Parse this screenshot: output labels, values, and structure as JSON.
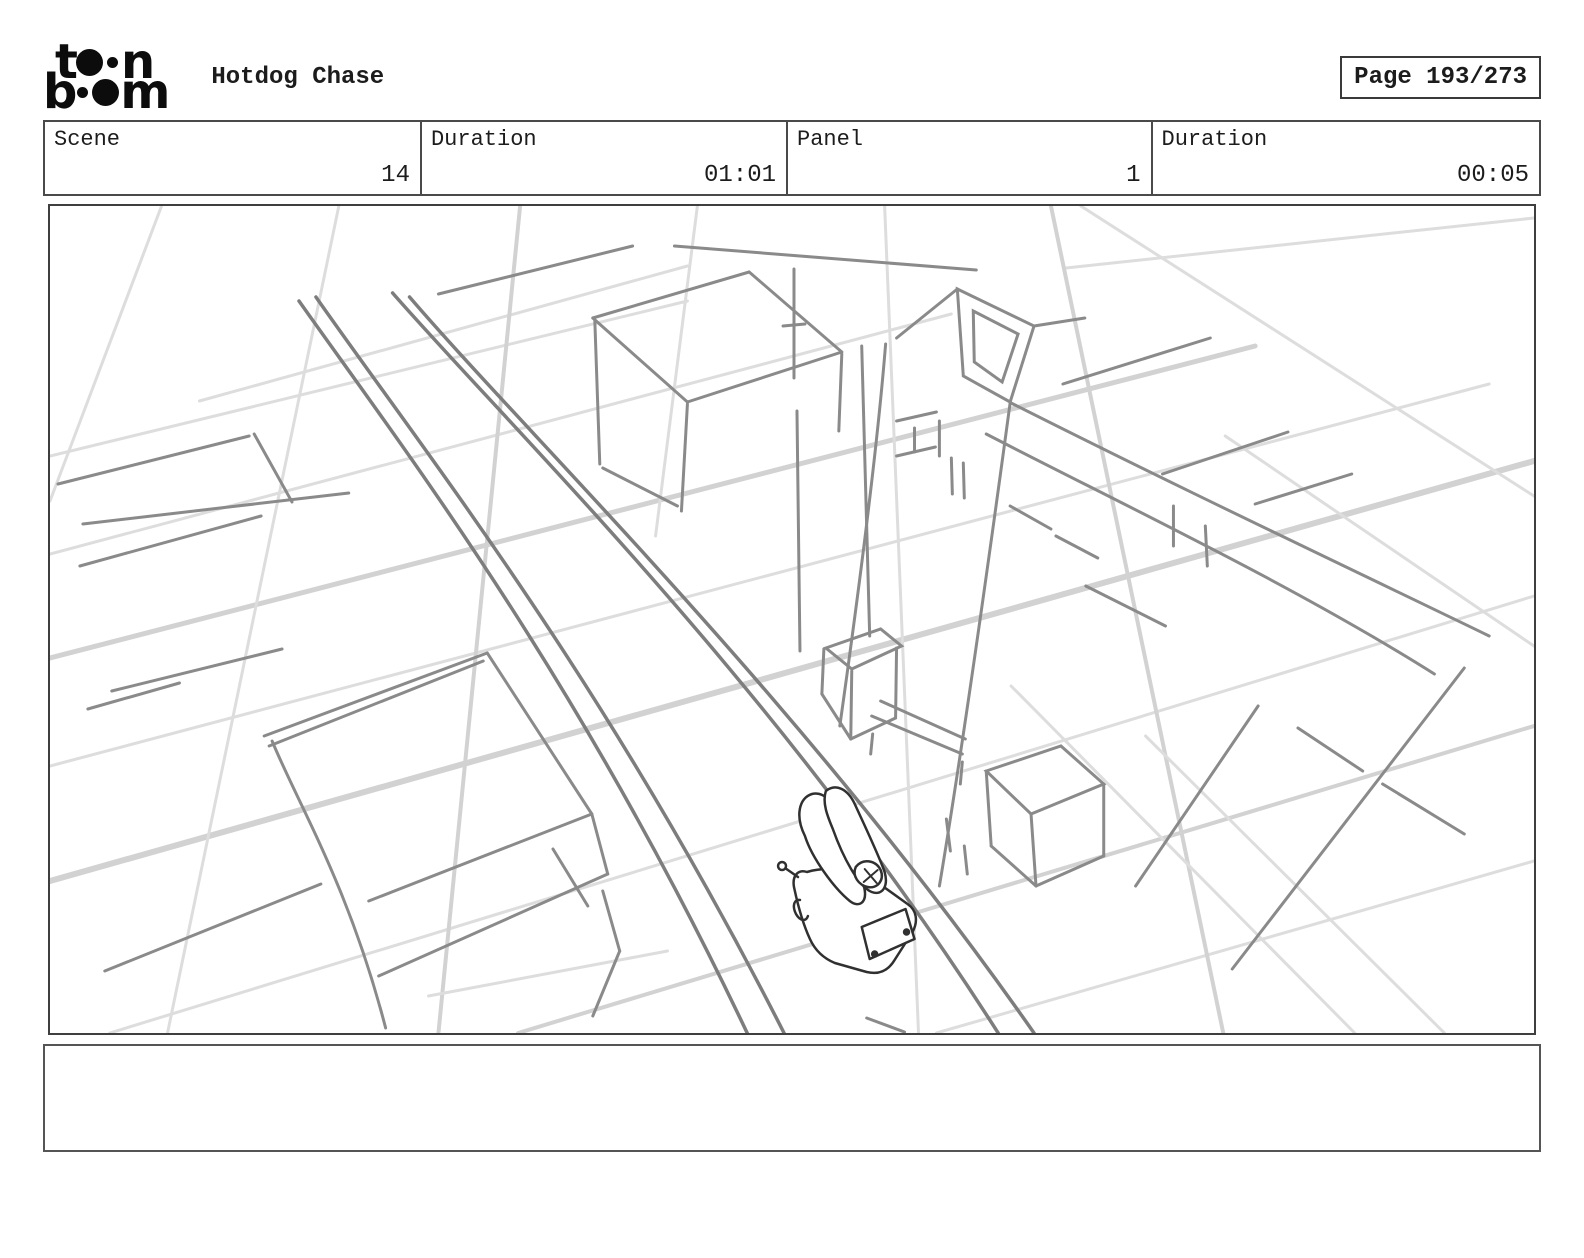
{
  "header": {
    "logo": {
      "l1a": "t",
      "l1b": "n",
      "l2a": "b",
      "l2b": "m"
    },
    "title": "Hotdog Chase",
    "page_label": "Page 193/273"
  },
  "info_row": {
    "cells": [
      {
        "label": "Scene",
        "value": "14"
      },
      {
        "label": "Duration",
        "value": "01:01"
      },
      {
        "label": "Panel",
        "value": "1"
      },
      {
        "label": "Duration",
        "value": "00:05"
      }
    ]
  },
  "panel": {
    "description": "rough pencil sketch: aerial perspective of city street grid with buildings, a rooftop billboard tower, and a hotdog truck driving down the street",
    "caption": ""
  },
  "colors": {
    "ink": "#1c1c1c",
    "border": "#4a4a4a",
    "sketch": "#8a8a8a",
    "sketch_dark": "#303030",
    "grid": "#dddddd",
    "grid_bold": "#d2d2d2",
    "street": "#7d7d7d",
    "paper": "#ffffff"
  }
}
